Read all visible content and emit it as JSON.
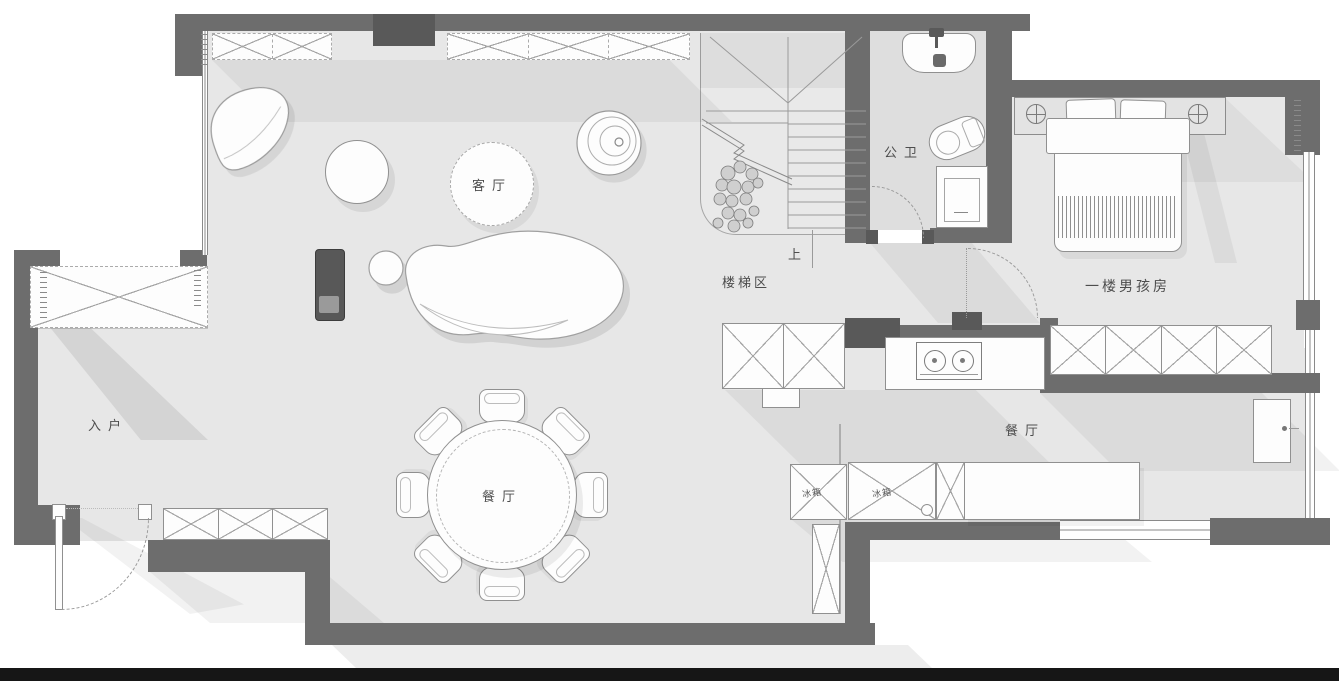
{
  "labels": {
    "living_room": "客厅",
    "entry": "入户",
    "dining_table": "餐厅",
    "dining_area": "餐厅",
    "stair_zone": "楼梯区",
    "stair_up": "上",
    "bathroom": "公卫",
    "boys_room": "一楼男孩房",
    "fridge_left": "冰箱",
    "fridge_right": "冰箱"
  },
  "colors": {
    "wall": "#6d6d6d",
    "wall_dark": "#595959",
    "floor": "#e7e7e7",
    "bathroom_floor": "#dedede",
    "outline": "#909090",
    "footer_bar": "#161616"
  }
}
